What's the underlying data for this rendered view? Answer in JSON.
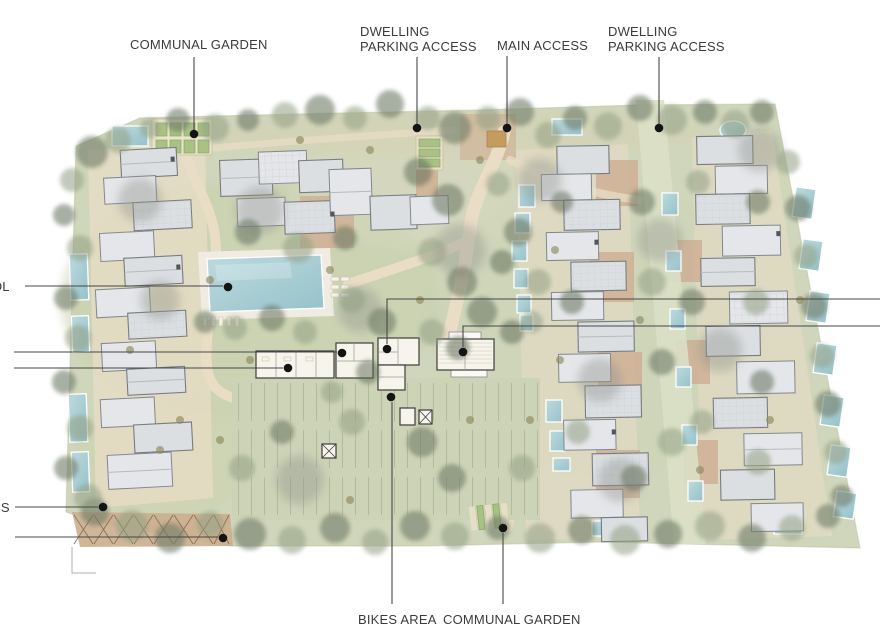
{
  "callouts": {
    "communal_garden_top": {
      "label": "COMMUNAL GARDEN"
    },
    "dwelling_parking_west": {
      "lines": [
        "DWELLING",
        "PARKING ACCESS"
      ]
    },
    "main_access": {
      "label": "MAIN ACCESS"
    },
    "dwelling_parking_east": {
      "lines": [
        "DWELLING",
        "PARKING ACCESS"
      ]
    },
    "pool_label_cutoff": {
      "label": "OL"
    },
    "access_label_cutoff": {
      "label": "SS"
    },
    "bikes_area": {
      "label": "BIKES AREA"
    },
    "communal_garden_bottom": {
      "label": "COMMUNAL GARDEN"
    }
  },
  "colors": {
    "background": "#ffffff",
    "label_text": "#3b3b3b",
    "leader_line": "#474747",
    "leader_dot": "#141414",
    "site_ground": "#d0d6bb",
    "parking_paving": "#cdd3b6",
    "path_cream": "#e9ddc6",
    "courtyard_brick": "#cfae92",
    "roof_gray": "#dcdfe2",
    "roof_edge": "#777c82",
    "pool_blue": "#a5cbd2",
    "tree_green": "#707c67",
    "tree_olive": "#93a084",
    "garden_bed_green": "#a9c185",
    "access_square": "#c59c5e"
  }
}
